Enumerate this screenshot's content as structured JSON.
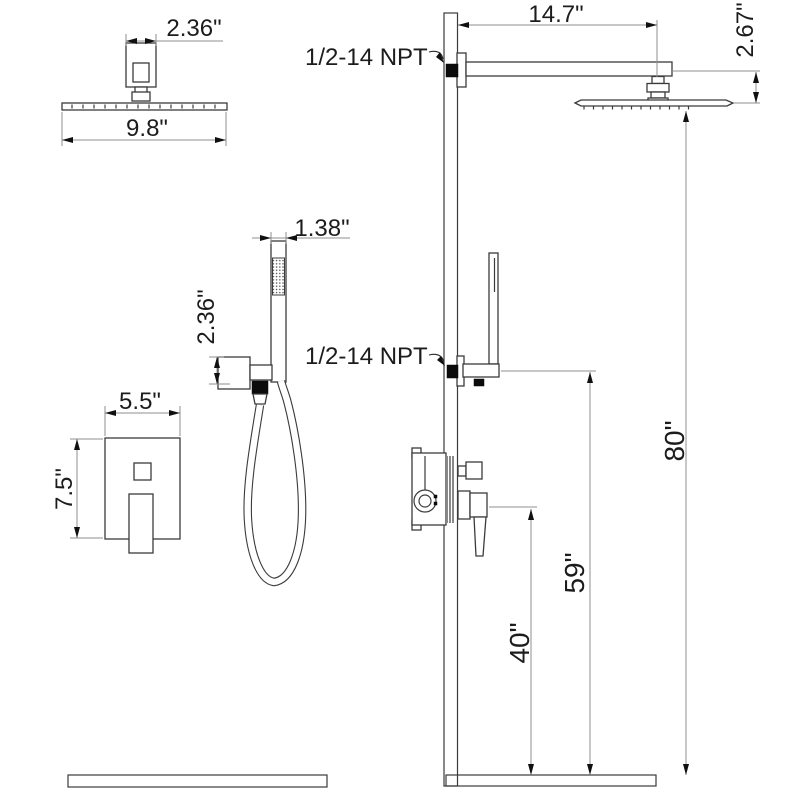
{
  "title": "Wall-mounted shower system installation dimension drawing",
  "colors": {
    "background": "#ffffff",
    "object_line": "#3b3b3b",
    "dimension_line": "#8f8f8f",
    "text": "#1c1c1c",
    "connector_fill": "#0b0b0b"
  },
  "labels": {
    "npt_top": "1/2-14 NPT",
    "npt_mid": "1/2-14 NPT"
  },
  "dimensions": {
    "head_hub_width": "2.36\"",
    "head_width": "9.8\"",
    "arm_length": "14.7\"",
    "head_drop": "2.67\"",
    "wand_width": "1.38\"",
    "holder_height": "2.36\"",
    "valve_plate_width": "5.5\"",
    "valve_plate_height": "7.5\"",
    "showerhead_height": "80\"",
    "handshower_height": "59\"",
    "valve_height": "40\""
  }
}
